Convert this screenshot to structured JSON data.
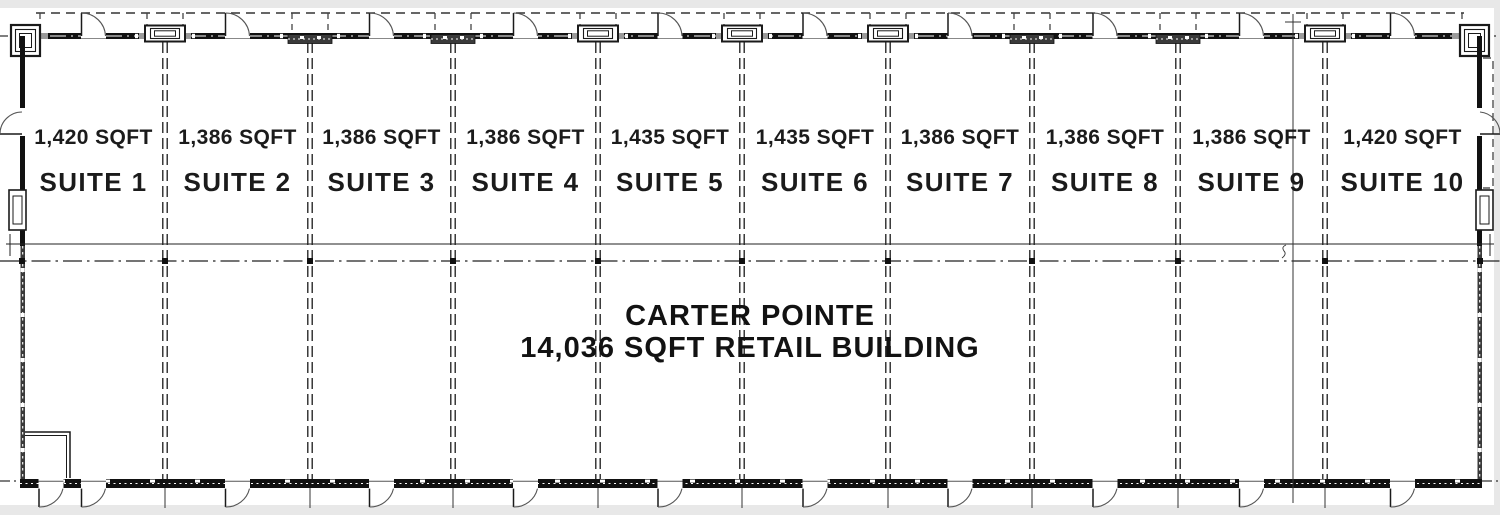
{
  "building": {
    "name": "CARTER POINTE",
    "subtitle": "14,036 SQFT RETAIL BUILDING"
  },
  "suites": [
    {
      "name": "SUITE 1",
      "sqft": "1,420 SQFT"
    },
    {
      "name": "SUITE 2",
      "sqft": "1,386 SQFT"
    },
    {
      "name": "SUITE 3",
      "sqft": "1,386 SQFT"
    },
    {
      "name": "SUITE 4",
      "sqft": "1,386 SQFT"
    },
    {
      "name": "SUITE 5",
      "sqft": "1,435 SQFT"
    },
    {
      "name": "SUITE 6",
      "sqft": "1,435 SQFT"
    },
    {
      "name": "SUITE 7",
      "sqft": "1,386 SQFT"
    },
    {
      "name": "SUITE 8",
      "sqft": "1,386 SQFT"
    },
    {
      "name": "SUITE 9",
      "sqft": "1,386 SQFT"
    },
    {
      "name": "SUITE 10",
      "sqft": "1,420 SQFT"
    }
  ],
  "plan": {
    "ink_color": "#1a1a1a",
    "wall_color": "#111111",
    "hatch_color": "#3a3a3a",
    "grey_color": "#9a9a9a",
    "sheet_color": "#ffffff",
    "margin_color": "#e8e8e8"
  }
}
